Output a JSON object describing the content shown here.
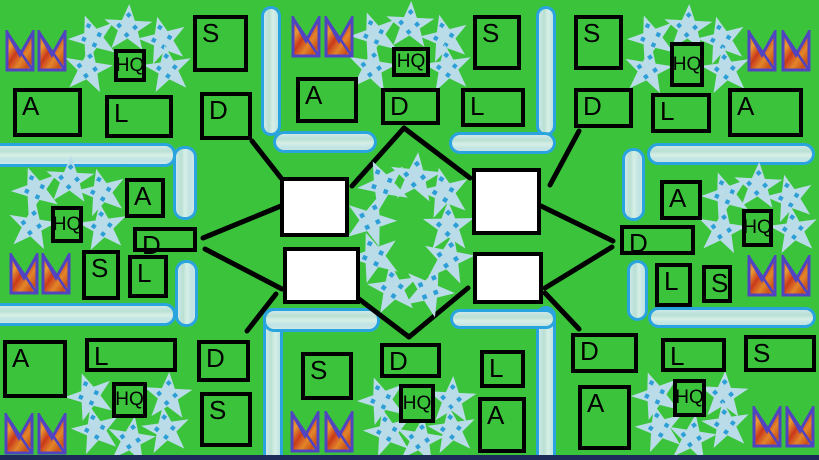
{
  "palette": {
    "background": "#3cc33c",
    "box_border": "#000000",
    "text_color": "#000000",
    "objective_fill": "#ffffff",
    "wall_border": "#29a4de",
    "wall_fill_streaks": [
      "#cde9ea",
      "#b9dfd2",
      "#d6efe6",
      "#bfe2e4"
    ],
    "star_fill": "#b9dce8",
    "star_dot": "#2e9fd6",
    "crown_border": "#5144c0",
    "crown_fills": [
      "#d9571d",
      "#e89b33",
      "#c9391b",
      "#e2862a",
      "#e8a83c"
    ],
    "connection_line": "#000000",
    "bottom_strip": "#1d2b5a"
  },
  "labels": {
    "headquarters": "HQ",
    "supply": "S",
    "armor": "A",
    "logistics": "L",
    "defense": "D"
  },
  "bases": [
    {
      "name": "top-left",
      "boxes": [
        {
          "label": "S",
          "x": 193,
          "y": 15,
          "w": 55,
          "h": 57
        },
        {
          "label": "HQ",
          "x": 114,
          "y": 49,
          "w": 32,
          "h": 33
        },
        {
          "label": "A",
          "x": 13,
          "y": 88,
          "w": 69,
          "h": 49
        },
        {
          "label": "L",
          "x": 105,
          "y": 95,
          "w": 68,
          "h": 43
        },
        {
          "label": "D",
          "x": 200,
          "y": 92,
          "w": 52,
          "h": 48
        }
      ],
      "crowns": [
        [
          5,
          30
        ],
        [
          37,
          30
        ]
      ],
      "stars": [
        [
          93,
          38
        ],
        [
          128,
          28
        ],
        [
          163,
          40
        ],
        [
          88,
          69
        ],
        [
          168,
          69
        ]
      ]
    },
    {
      "name": "top-middle",
      "boxes": [
        {
          "label": "HQ",
          "x": 392,
          "y": 47,
          "w": 38,
          "h": 30
        },
        {
          "label": "S",
          "x": 473,
          "y": 15,
          "w": 48,
          "h": 55
        },
        {
          "label": "A",
          "x": 296,
          "y": 77,
          "w": 62,
          "h": 46
        },
        {
          "label": "D",
          "x": 381,
          "y": 88,
          "w": 59,
          "h": 37
        },
        {
          "label": "L",
          "x": 461,
          "y": 88,
          "w": 64,
          "h": 39
        }
      ],
      "crowns": [
        [
          291,
          16
        ],
        [
          324,
          16
        ]
      ],
      "stars": [
        [
          375,
          35
        ],
        [
          410,
          25
        ],
        [
          445,
          38
        ],
        [
          372,
          68
        ],
        [
          448,
          68
        ]
      ]
    },
    {
      "name": "top-right",
      "boxes": [
        {
          "label": "S",
          "x": 574,
          "y": 15,
          "w": 49,
          "h": 55
        },
        {
          "label": "HQ",
          "x": 670,
          "y": 42,
          "w": 34,
          "h": 45
        },
        {
          "label": "D",
          "x": 574,
          "y": 88,
          "w": 59,
          "h": 40
        },
        {
          "label": "L",
          "x": 651,
          "y": 93,
          "w": 60,
          "h": 40
        },
        {
          "label": "A",
          "x": 728,
          "y": 88,
          "w": 75,
          "h": 49
        }
      ],
      "crowns": [
        [
          747,
          30
        ],
        [
          781,
          30
        ]
      ],
      "stars": [
        [
          652,
          38
        ],
        [
          688,
          28
        ],
        [
          722,
          40
        ],
        [
          648,
          70
        ],
        [
          726,
          70
        ]
      ]
    },
    {
      "name": "middle-left",
      "boxes": [
        {
          "label": "HQ",
          "x": 51,
          "y": 206,
          "w": 32,
          "h": 37
        },
        {
          "label": "A",
          "x": 125,
          "y": 178,
          "w": 40,
          "h": 40
        },
        {
          "label": "D",
          "x": 133,
          "y": 227,
          "w": 64,
          "h": 25
        },
        {
          "label": "S",
          "x": 82,
          "y": 250,
          "w": 38,
          "h": 50
        },
        {
          "label": "L",
          "x": 128,
          "y": 255,
          "w": 40,
          "h": 43
        }
      ],
      "crowns": [
        [
          9,
          253
        ],
        [
          41,
          253
        ]
      ],
      "stars": [
        [
          36,
          190
        ],
        [
          70,
          180
        ],
        [
          102,
          192
        ],
        [
          32,
          226
        ],
        [
          103,
          227
        ]
      ]
    },
    {
      "name": "middle-right",
      "boxes": [
        {
          "label": "A",
          "x": 660,
          "y": 180,
          "w": 42,
          "h": 40
        },
        {
          "label": "D",
          "x": 620,
          "y": 225,
          "w": 75,
          "h": 30
        },
        {
          "label": "L",
          "x": 655,
          "y": 263,
          "w": 37,
          "h": 44
        },
        {
          "label": "S",
          "x": 702,
          "y": 265,
          "w": 30,
          "h": 38
        },
        {
          "label": "HQ",
          "x": 742,
          "y": 209,
          "w": 31,
          "h": 38
        }
      ],
      "crowns": [
        [
          747,
          255
        ],
        [
          781,
          255
        ]
      ],
      "stars": [
        [
          726,
          195
        ],
        [
          758,
          186
        ],
        [
          790,
          198
        ],
        [
          722,
          230
        ],
        [
          794,
          230
        ]
      ]
    },
    {
      "name": "bottom-left",
      "boxes": [
        {
          "label": "A",
          "x": 3,
          "y": 340,
          "w": 64,
          "h": 58
        },
        {
          "label": "L",
          "x": 85,
          "y": 338,
          "w": 92,
          "h": 34
        },
        {
          "label": "D",
          "x": 197,
          "y": 340,
          "w": 53,
          "h": 42
        },
        {
          "label": "S",
          "x": 200,
          "y": 392,
          "w": 52,
          "h": 55
        },
        {
          "label": "HQ",
          "x": 112,
          "y": 382,
          "w": 35,
          "h": 36
        }
      ],
      "crowns": [
        [
          4,
          413
        ],
        [
          37,
          413
        ]
      ],
      "stars": [
        [
          90,
          396
        ],
        [
          168,
          396
        ],
        [
          96,
          430
        ],
        [
          131,
          440
        ],
        [
          166,
          430
        ]
      ]
    },
    {
      "name": "bottom-middle",
      "boxes": [
        {
          "label": "S",
          "x": 301,
          "y": 352,
          "w": 52,
          "h": 48
        },
        {
          "label": "D",
          "x": 380,
          "y": 343,
          "w": 61,
          "h": 35
        },
        {
          "label": "L",
          "x": 480,
          "y": 350,
          "w": 45,
          "h": 38
        },
        {
          "label": "A",
          "x": 478,
          "y": 397,
          "w": 48,
          "h": 56
        },
        {
          "label": "HQ",
          "x": 399,
          "y": 384,
          "w": 36,
          "h": 39
        }
      ],
      "crowns": [
        [
          290,
          411
        ],
        [
          324,
          411
        ]
      ],
      "stars": [
        [
          382,
          400
        ],
        [
          452,
          400
        ],
        [
          388,
          432
        ],
        [
          420,
          440
        ],
        [
          452,
          430
        ]
      ]
    },
    {
      "name": "bottom-right",
      "boxes": [
        {
          "label": "D",
          "x": 571,
          "y": 333,
          "w": 67,
          "h": 40
        },
        {
          "label": "L",
          "x": 661,
          "y": 338,
          "w": 65,
          "h": 34
        },
        {
          "label": "S",
          "x": 744,
          "y": 335,
          "w": 72,
          "h": 37
        },
        {
          "label": "A",
          "x": 578,
          "y": 385,
          "w": 53,
          "h": 65
        },
        {
          "label": "HQ",
          "x": 673,
          "y": 379,
          "w": 33,
          "h": 38
        }
      ],
      "crowns": [
        [
          752,
          406
        ],
        [
          785,
          406
        ]
      ],
      "stars": [
        [
          656,
          395
        ],
        [
          724,
          395
        ],
        [
          660,
          428
        ],
        [
          692,
          438
        ],
        [
          726,
          425
        ]
      ]
    }
  ],
  "objectives": [
    {
      "x": 280,
      "y": 177,
      "w": 69,
      "h": 60
    },
    {
      "x": 283,
      "y": 247,
      "w": 77,
      "h": 57
    },
    {
      "x": 472,
      "y": 168,
      "w": 69,
      "h": 67
    },
    {
      "x": 473,
      "y": 252,
      "w": 70,
      "h": 52
    }
  ],
  "center_ring_stars": [
    [
      383,
      184
    ],
    [
      415,
      177
    ],
    [
      444,
      192
    ],
    [
      370,
      220
    ],
    [
      448,
      226
    ],
    [
      374,
      256
    ],
    [
      448,
      258
    ],
    [
      393,
      288
    ],
    [
      428,
      290
    ]
  ],
  "walls": [
    {
      "dir": "v",
      "x": 261,
      "y": 6,
      "w": 20,
      "h": 130
    },
    {
      "dir": "v",
      "x": 536,
      "y": 6,
      "w": 20,
      "h": 130
    },
    {
      "dir": "h",
      "x": 273,
      "y": 131,
      "w": 104,
      "h": 22
    },
    {
      "dir": "h",
      "x": 449,
      "y": 132,
      "w": 107,
      "h": 22
    },
    {
      "dir": "h",
      "x": -12,
      "y": 143,
      "w": 188,
      "h": 24
    },
    {
      "dir": "v",
      "x": 173,
      "y": 146,
      "w": 24,
      "h": 74
    },
    {
      "dir": "v",
      "x": 175,
      "y": 260,
      "w": 23,
      "h": 67
    },
    {
      "dir": "h",
      "x": -12,
      "y": 303,
      "w": 188,
      "h": 23
    },
    {
      "dir": "h",
      "x": 647,
      "y": 143,
      "w": 168,
      "h": 22
    },
    {
      "dir": "v",
      "x": 622,
      "y": 148,
      "w": 23,
      "h": 73
    },
    {
      "dir": "v",
      "x": 627,
      "y": 260,
      "w": 21,
      "h": 61
    },
    {
      "dir": "h",
      "x": 648,
      "y": 307,
      "w": 168,
      "h": 21
    },
    {
      "dir": "v",
      "x": 263,
      "y": 308,
      "w": 20,
      "h": 158
    },
    {
      "dir": "h",
      "x": 263,
      "y": 308,
      "w": 117,
      "h": 24
    },
    {
      "dir": "v",
      "x": 536,
      "y": 306,
      "w": 20,
      "h": 160
    },
    {
      "dir": "h",
      "x": 450,
      "y": 309,
      "w": 106,
      "h": 20
    }
  ],
  "connections": [
    [
      252,
      141,
      281,
      178
    ],
    [
      352,
      186,
      404,
      128
    ],
    [
      404,
      128,
      470,
      178
    ],
    [
      579,
      131,
      550,
      185
    ],
    [
      203,
      238,
      281,
      206
    ],
    [
      205,
      249,
      282,
      289
    ],
    [
      541,
      206,
      613,
      241
    ],
    [
      545,
      288,
      612,
      247
    ],
    [
      276,
      294,
      247,
      331
    ],
    [
      359,
      299,
      409,
      337
    ],
    [
      468,
      288,
      409,
      337
    ],
    [
      545,
      293,
      579,
      329
    ]
  ],
  "bottom_strip": {
    "x": 0,
    "y": 455,
    "w": 819,
    "h": 5
  },
  "canvas": {
    "width": 819,
    "height": 460
  }
}
